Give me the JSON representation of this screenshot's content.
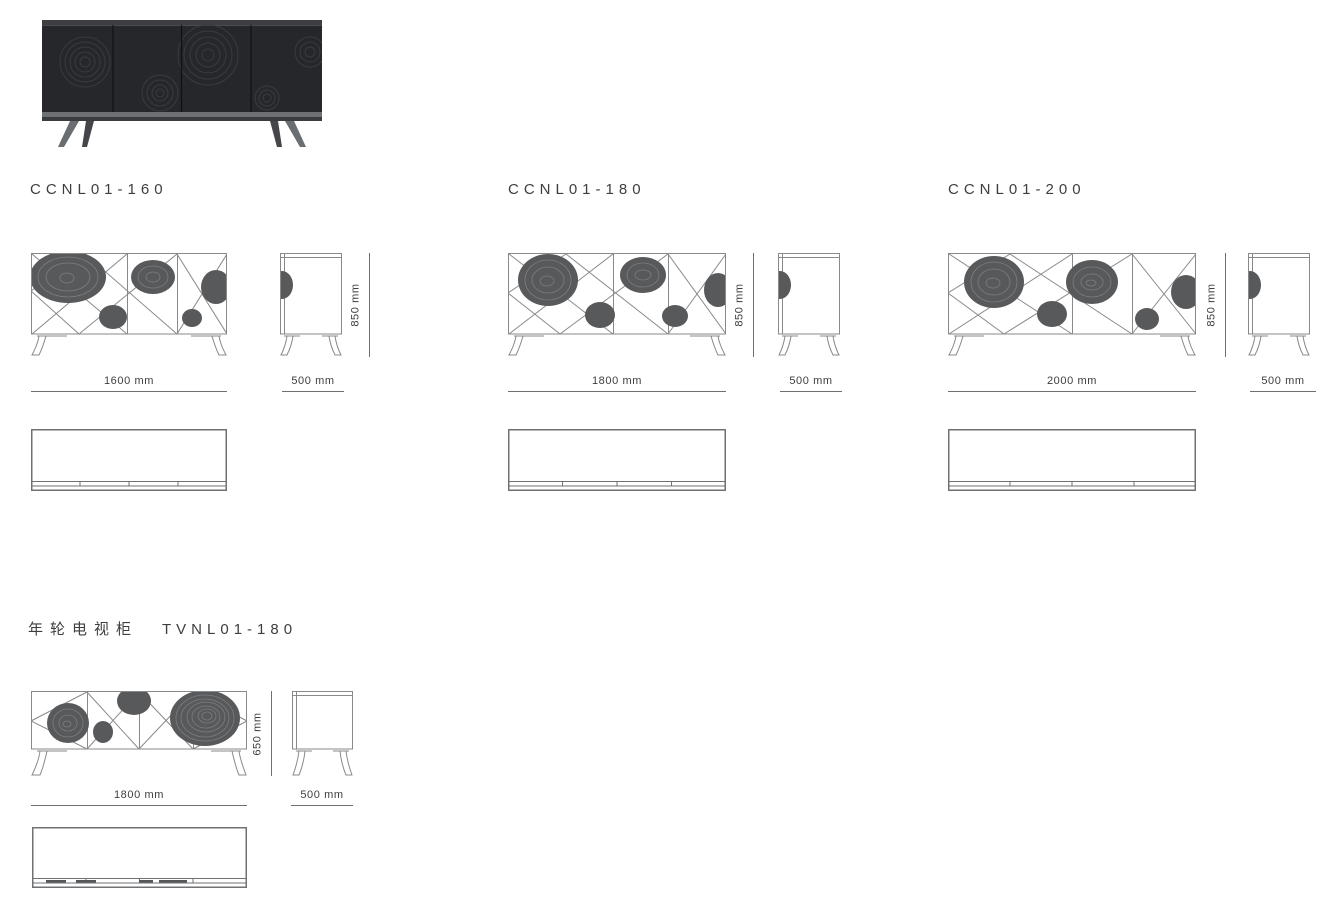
{
  "page": {
    "background": "#ffffff"
  },
  "colors": {
    "drawing_line": "#87898b",
    "pattern_fill": "#58595b",
    "dimension_line": "#6e7072",
    "text": "#3d3e40",
    "photo_body": "#26272a",
    "photo_leg": "#6a6d71"
  },
  "sections": [
    {
      "model": "CCNL01-160",
      "width": "1600 mm",
      "depth": "500 mm",
      "height": "850 mm"
    },
    {
      "model": "CCNL01-180",
      "width": "1800 mm",
      "depth": "500 mm",
      "height": "850 mm"
    },
    {
      "model": "CCNL01-200",
      "width": "2000 mm",
      "depth": "500 mm",
      "height": "850 mm"
    }
  ],
  "tv": {
    "name_cn": "年轮电视柜",
    "model": "TVNL01-180",
    "width": "1800 mm",
    "depth": "500 mm",
    "height": "650 mm"
  }
}
